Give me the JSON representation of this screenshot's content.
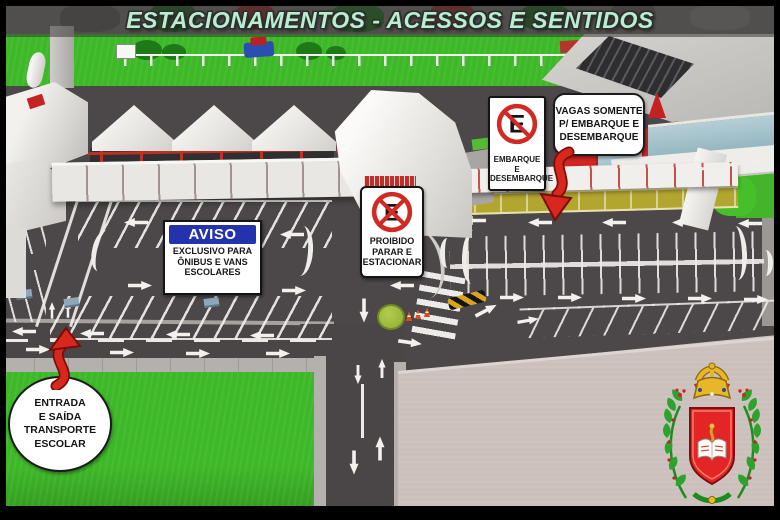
{
  "title": "ESTACIONAMENTOS - ACESSOS E SENTIDOS",
  "signs": {
    "aviso": {
      "header": "AVISO",
      "lines": [
        "EXCLUSIVO PARA",
        "ÔNIBUS E VANS",
        "ESCOLARES"
      ]
    },
    "no_stopping": {
      "icon": "no-stopping-icon",
      "lines": [
        "PROIBIDO",
        "PARAR E",
        "ESTACIONAR"
      ]
    },
    "no_parking": {
      "icon": "no-parking-icon",
      "lines": [
        "EMBARQUE E",
        "DESEMBARQUE"
      ]
    }
  },
  "callouts": {
    "vagas": {
      "lines": [
        "VAGAS SOMENTE",
        "P/ EMBARQUE E",
        "DESEMBARQUE"
      ]
    },
    "entrada": {
      "lines": [
        "ENTRADA",
        "E SAÍDA",
        "TRANSPORTE",
        "ESCOLAR"
      ]
    }
  },
  "icons": {
    "no_stopping": "no-stopping-icon",
    "no_parking": "no-parking-icon",
    "crest": "coat-of-arms"
  },
  "colors": {
    "title_text": "#b9eed0",
    "asphalt": "#4c4749",
    "grass": "#3db827",
    "plaza": "#cbc0bc",
    "embark_zone_yellow": "#b3a62f",
    "aviso_header_blue": "#2433ad",
    "prohibition_red": "#d12a23",
    "attention_arrow_red": "#d8281e",
    "crest_gold": "#e9b62a",
    "crest_red": "#e32525",
    "crest_green": "#2da32d"
  }
}
